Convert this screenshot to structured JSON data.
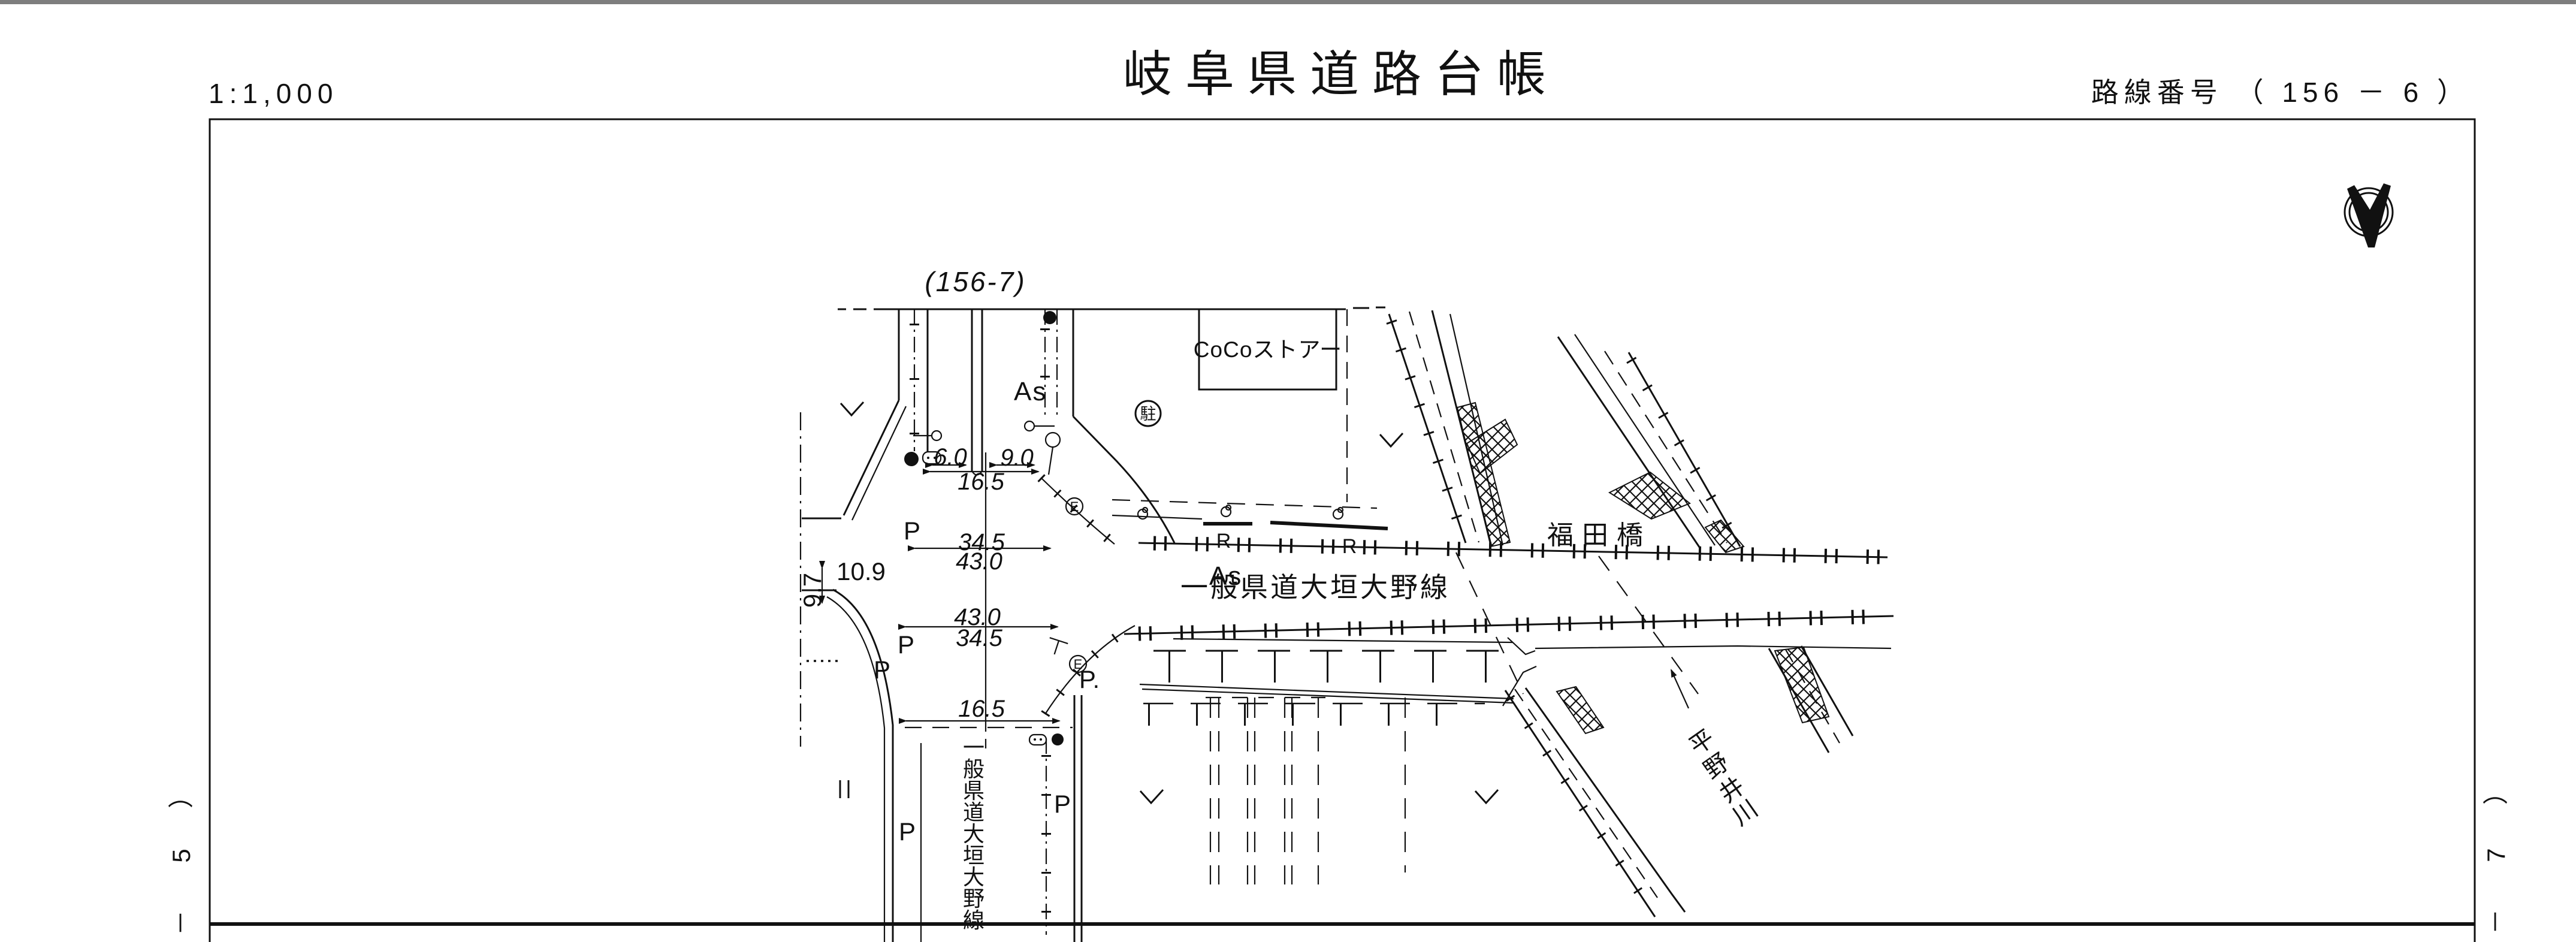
{
  "header": {
    "scale": "1:1,000",
    "title": "岐阜県道路台帳",
    "route_number": "路線番号 （ 156 －  6  ）"
  },
  "margins": {
    "left_sheet": [
      "）",
      "5",
      "－"
    ],
    "right_sheet": [
      "）",
      "7",
      "－"
    ]
  },
  "map": {
    "adjacent_sheet": "(156-7)",
    "store": "CoCoストアー",
    "parking_circle": "駐",
    "bridge": "福田橋",
    "river": [
      "平",
      "野",
      "井",
      "川"
    ],
    "route_name": "一般県道大垣大野線",
    "route_name_vertical": [
      "一",
      "般",
      "県",
      "道",
      "大",
      "垣",
      "大",
      "野",
      "線"
    ],
    "surface": "As",
    "dims": {
      "w_left": "6.0",
      "w_right": "9.0",
      "w_north": "16.5",
      "a_top": "34.5",
      "a_bottom": "43.0",
      "b_top": "43.0",
      "b_bottom": "34.5",
      "w_south": "16.5",
      "w_west": "10.9",
      "h_west": "9.7"
    },
    "marks": {
      "p": "P",
      "p_dot": "P.",
      "e": "E",
      "r": "R"
    }
  }
}
